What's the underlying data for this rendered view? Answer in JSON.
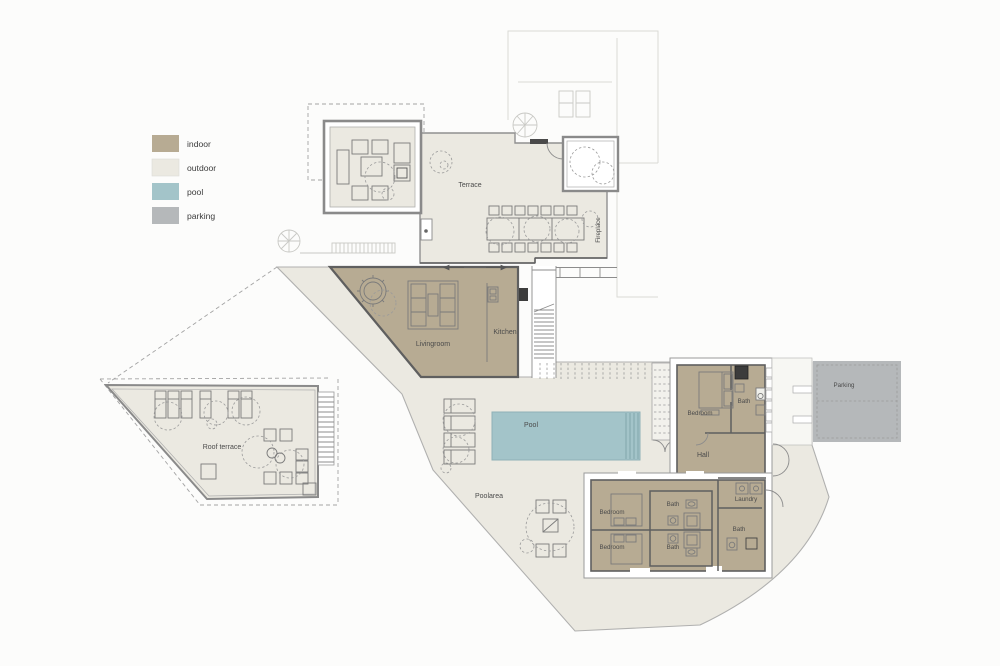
{
  "legend": {
    "items": [
      {
        "label": "indoor",
        "color": "#b7ab93"
      },
      {
        "label": "outdoor",
        "color": "#ebe9e1"
      },
      {
        "label": "pool",
        "color": "#a3c4c9"
      },
      {
        "label": "parking",
        "color": "#b5b8ba"
      }
    ]
  },
  "rooms": {
    "terrace": "Terrace",
    "fireplace": "Fireplace",
    "livingroom": "Livingroom",
    "kitchen": "Kitchen",
    "pool": "Pool",
    "poolarea": "Poolarea",
    "roof_terrace": "Roof terrace",
    "bedroom_ne": "Bedroom",
    "bath_ne": "Bath",
    "hall": "Hall",
    "laundry": "Laundry",
    "bedroom_s1": "Bedroom",
    "bedroom_s2": "Bedroom",
    "bath_s1": "Bath",
    "bath_s2": "Bath",
    "bath_s3": "Bath",
    "parking": "Parking"
  },
  "colors": {
    "wall": "#5f5f5f",
    "thin_line": "#8c8c8c",
    "faint_line": "#dadad6",
    "label_text": "#4b4b4b"
  }
}
